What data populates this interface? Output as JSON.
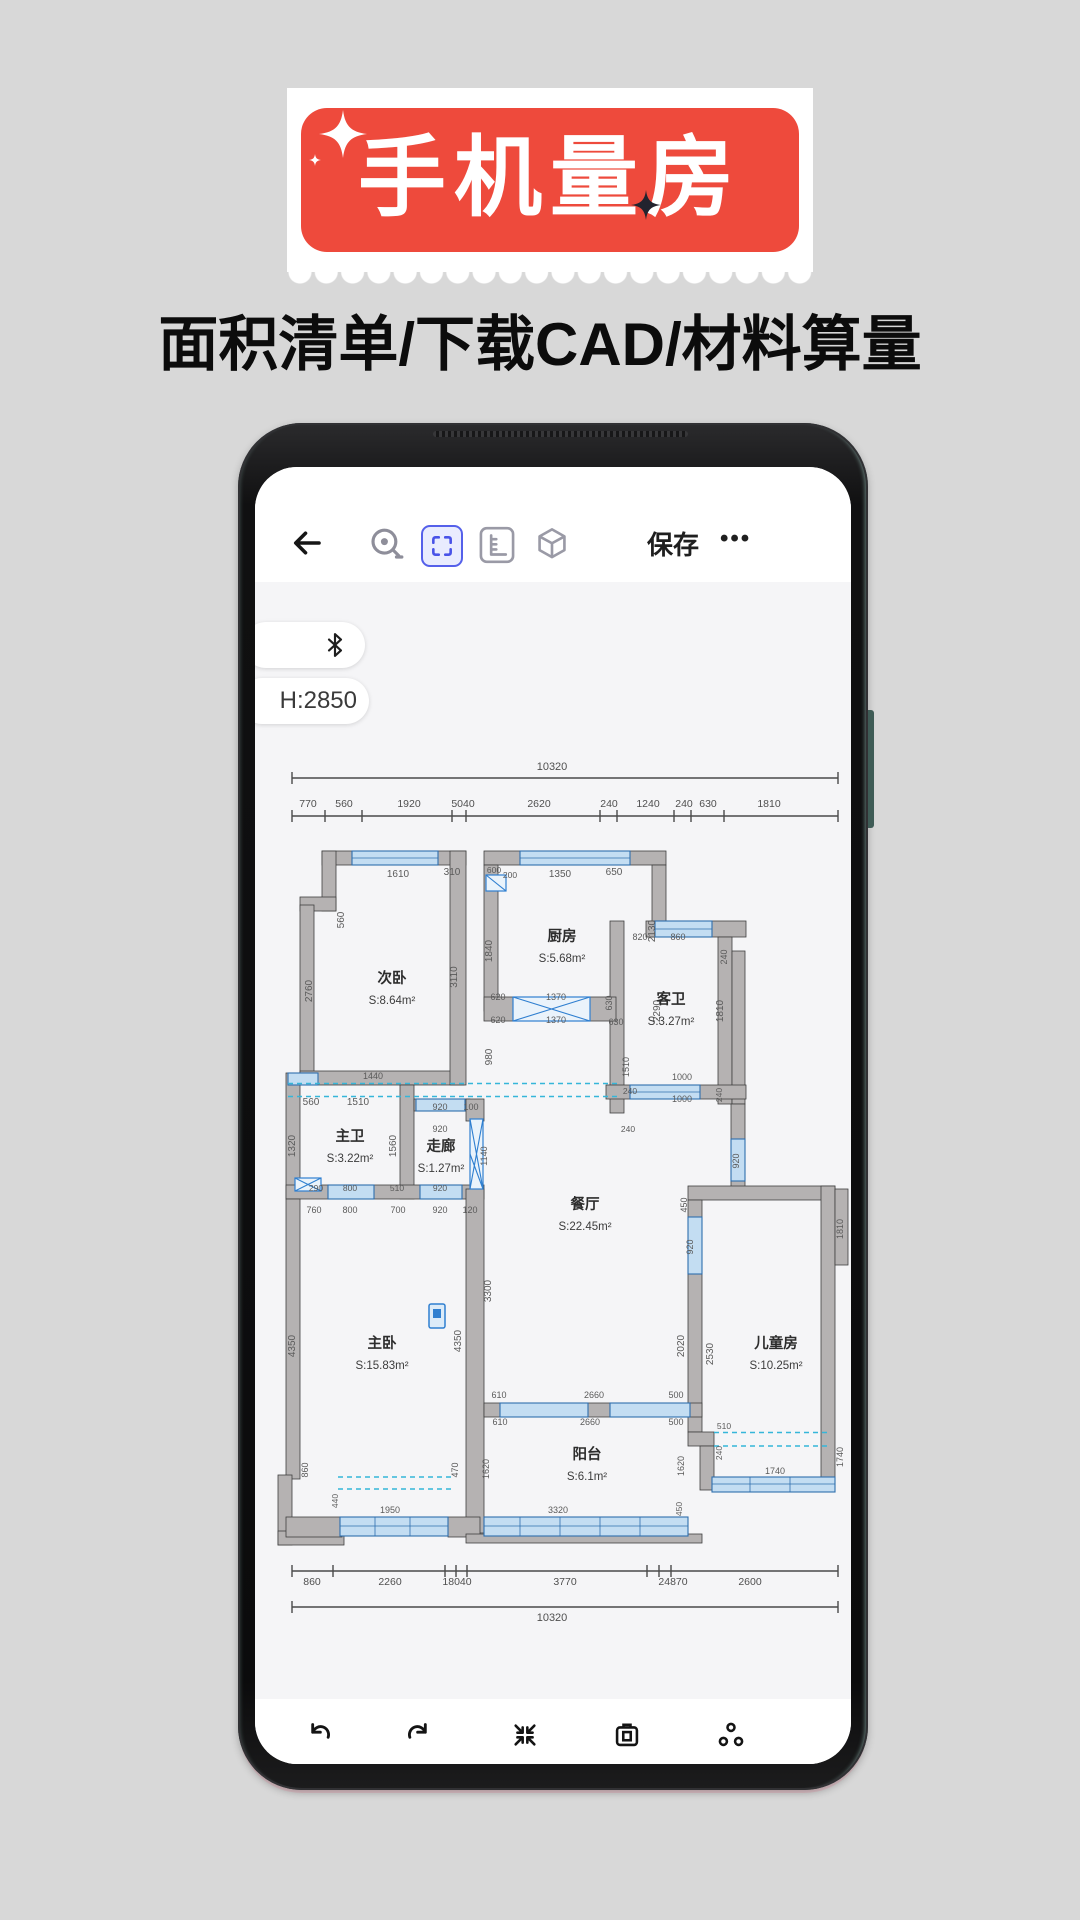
{
  "banner": {
    "title": "手机量房",
    "subtitle": "面积清单/下载CAD/材料算量",
    "accent_color": "#ee4a3c"
  },
  "phone_app": {
    "toolbar": {
      "save_label": "保存",
      "more_label": "•••",
      "active_tool_color": "#5560ea"
    },
    "pills": {
      "height_value": "H:2850"
    },
    "icons": [
      "back-arrow",
      "tape-measure",
      "selection-frame",
      "ruler",
      "cube-3d",
      "bluetooth",
      "undo",
      "redo",
      "collapse",
      "screenshot-camera",
      "nodes-share"
    ]
  },
  "floorplan": {
    "wall_color": "#b5b2b2",
    "window_color": "#c3ddf2",
    "rooms": [
      {
        "name": "次卧",
        "area": "S:8.64m²",
        "x": 392,
        "y": 984
      },
      {
        "name": "厨房",
        "area": "S:5.68m²",
        "x": 562,
        "y": 942
      },
      {
        "name": "客卫",
        "area": "S:3.27m²",
        "x": 671,
        "y": 1005
      },
      {
        "name": "主卫",
        "area": "S:3.22m²",
        "x": 350,
        "y": 1142
      },
      {
        "name": "走廊",
        "area": "S:1.27m²",
        "x": 441,
        "y": 1152
      },
      {
        "name": "餐厅",
        "area": "S:22.45m²",
        "x": 585,
        "y": 1210
      },
      {
        "name": "主卧",
        "area": "S:15.83m²",
        "x": 382,
        "y": 1349
      },
      {
        "name": "儿童房",
        "area": "S:10.25m²",
        "x": 776,
        "y": 1349
      },
      {
        "name": "阳台",
        "area": "S:6.1m²",
        "x": 587,
        "y": 1460
      }
    ],
    "dims": [
      {
        "t": "10320",
        "x": 552,
        "y": 771,
        "s": 11,
        "cls": "rlabel"
      },
      {
        "t": "770",
        "x": 308,
        "y": 808,
        "s": 10.5,
        "cls": "rlabel"
      },
      {
        "t": "560",
        "x": 344,
        "y": 808,
        "s": 10.5,
        "cls": "rlabel"
      },
      {
        "t": "1920",
        "x": 409,
        "y": 808,
        "s": 10.5,
        "cls": "rlabel"
      },
      {
        "t": "5040",
        "x": 463,
        "y": 808,
        "s": 10.5,
        "cls": "rlabel"
      },
      {
        "t": "2620",
        "x": 539,
        "y": 808,
        "s": 10.5,
        "cls": "rlabel"
      },
      {
        "t": "240",
        "x": 609,
        "y": 808,
        "s": 10.5,
        "cls": "rlabel"
      },
      {
        "t": "1240",
        "x": 648,
        "y": 808,
        "s": 10.5,
        "cls": "rlabel"
      },
      {
        "t": "240",
        "x": 684,
        "y": 808,
        "s": 10.5,
        "cls": "rlabel"
      },
      {
        "t": "630",
        "x": 708,
        "y": 808,
        "s": 10.5,
        "cls": "rlabel"
      },
      {
        "t": "1810",
        "x": 769,
        "y": 808,
        "s": 10.5,
        "cls": "rlabel"
      },
      {
        "t": "860",
        "x": 312,
        "y": 1586,
        "s": 10.5,
        "cls": "rlabel"
      },
      {
        "t": "2260",
        "x": 390,
        "y": 1586,
        "s": 10.5,
        "cls": "rlabel"
      },
      {
        "t": "18040",
        "x": 457,
        "y": 1586,
        "s": 10.5,
        "cls": "rlabel"
      },
      {
        "t": "3770",
        "x": 565,
        "y": 1586,
        "s": 10.5,
        "cls": "rlabel"
      },
      {
        "t": "24870",
        "x": 673,
        "y": 1586,
        "s": 10.5,
        "cls": "rlabel"
      },
      {
        "t": "2600",
        "x": 750,
        "y": 1586,
        "s": 10.5,
        "cls": "rlabel"
      },
      {
        "t": "10320",
        "x": 552,
        "y": 1622,
        "s": 11,
        "cls": "rlabel"
      },
      {
        "t": "1610",
        "x": 398,
        "y": 878
      },
      {
        "t": "310",
        "x": 452,
        "y": 876
      },
      {
        "t": "600",
        "x": 494,
        "y": 874,
        "s": 8.5
      },
      {
        "t": "200",
        "x": 510,
        "y": 879,
        "s": 8.5
      },
      {
        "t": "1350",
        "x": 560,
        "y": 878
      },
      {
        "t": "650",
        "x": 614,
        "y": 876
      },
      {
        "t": "560",
        "x": 344,
        "y": 921,
        "r": -90
      },
      {
        "t": "2760",
        "x": 312,
        "y": 992,
        "r": -90
      },
      {
        "t": "3110",
        "x": 457,
        "y": 978,
        "r": -90
      },
      {
        "t": "1840",
        "x": 492,
        "y": 952,
        "r": -90
      },
      {
        "t": "2130",
        "x": 655,
        "y": 932,
        "r": -90
      },
      {
        "t": "820",
        "x": 640,
        "y": 941,
        "s": 9
      },
      {
        "t": "860",
        "x": 678,
        "y": 941,
        "s": 9
      },
      {
        "t": "240",
        "x": 727,
        "y": 958,
        "r": -90,
        "s": 9
      },
      {
        "t": "620",
        "x": 498,
        "y": 1001,
        "s": 9
      },
      {
        "t": "1370",
        "x": 556,
        "y": 1001,
        "s": 9
      },
      {
        "t": "620",
        "x": 498,
        "y": 1024,
        "s": 9
      },
      {
        "t": "1370",
        "x": 556,
        "y": 1024,
        "s": 9
      },
      {
        "t": "980",
        "x": 492,
        "y": 1058,
        "r": -90
      },
      {
        "t": "630",
        "x": 612,
        "y": 1004,
        "r": -90,
        "s": 9
      },
      {
        "t": "630",
        "x": 616,
        "y": 1026,
        "s": 9
      },
      {
        "t": "2290",
        "x": 660,
        "y": 1012,
        "r": -90
      },
      {
        "t": "1810",
        "x": 723,
        "y": 1012,
        "r": -90
      },
      {
        "t": "1440",
        "x": 373,
        "y": 1080,
        "s": 9
      },
      {
        "t": "1510",
        "x": 629,
        "y": 1068,
        "r": -90,
        "s": 9
      },
      {
        "t": "240",
        "x": 630,
        "y": 1095,
        "s": 8.5
      },
      {
        "t": "1000",
        "x": 682,
        "y": 1081,
        "s": 9
      },
      {
        "t": "1000",
        "x": 682,
        "y": 1103,
        "s": 9
      },
      {
        "t": "240",
        "x": 722,
        "y": 1096,
        "r": -90,
        "s": 8.5
      },
      {
        "t": "240",
        "x": 628,
        "y": 1133,
        "s": 8.5
      },
      {
        "t": "920",
        "x": 739,
        "y": 1162,
        "r": -90,
        "s": 9
      },
      {
        "t": "560",
        "x": 311,
        "y": 1106
      },
      {
        "t": "1510",
        "x": 358,
        "y": 1106
      },
      {
        "t": "1320",
        "x": 295,
        "y": 1147,
        "r": -90
      },
      {
        "t": "1560",
        "x": 396,
        "y": 1147,
        "r": -90
      },
      {
        "t": "920",
        "x": 440,
        "y": 1111,
        "s": 9
      },
      {
        "t": "100",
        "x": 471,
        "y": 1111,
        "s": 9
      },
      {
        "t": "920",
        "x": 440,
        "y": 1133,
        "s": 9
      },
      {
        "t": "1140",
        "x": 487,
        "y": 1157,
        "r": -90,
        "s": 9
      },
      {
        "t": "290",
        "x": 316,
        "y": 1192,
        "s": 8.5
      },
      {
        "t": "800",
        "x": 350,
        "y": 1192,
        "s": 8.5
      },
      {
        "t": "510",
        "x": 397,
        "y": 1192,
        "s": 8.5
      },
      {
        "t": "920",
        "x": 440,
        "y": 1192,
        "s": 8.5
      },
      {
        "t": "760",
        "x": 314,
        "y": 1214,
        "s": 9
      },
      {
        "t": "800",
        "x": 350,
        "y": 1214,
        "s": 9
      },
      {
        "t": "700",
        "x": 398,
        "y": 1214,
        "s": 9
      },
      {
        "t": "920",
        "x": 440,
        "y": 1214,
        "s": 9
      },
      {
        "t": "120",
        "x": 470,
        "y": 1214,
        "s": 9
      },
      {
        "t": "450",
        "x": 687,
        "y": 1206,
        "r": -90,
        "s": 9
      },
      {
        "t": "920",
        "x": 693,
        "y": 1248,
        "r": -90,
        "s": 9
      },
      {
        "t": "3300",
        "x": 491,
        "y": 1292,
        "r": -90
      },
      {
        "t": "2020",
        "x": 684,
        "y": 1347,
        "r": -90
      },
      {
        "t": "2530",
        "x": 713,
        "y": 1355,
        "r": -90
      },
      {
        "t": "1810",
        "x": 843,
        "y": 1230,
        "r": -90,
        "s": 9
      },
      {
        "t": "4350",
        "x": 295,
        "y": 1347,
        "r": -90
      },
      {
        "t": "4350",
        "x": 461,
        "y": 1342,
        "r": -90
      },
      {
        "t": "610",
        "x": 499,
        "y": 1399,
        "s": 9
      },
      {
        "t": "2660",
        "x": 594,
        "y": 1399,
        "s": 9
      },
      {
        "t": "500",
        "x": 676,
        "y": 1399,
        "s": 9
      },
      {
        "t": "610",
        "x": 500,
        "y": 1426,
        "s": 9
      },
      {
        "t": "2660",
        "x": 590,
        "y": 1426,
        "s": 9
      },
      {
        "t": "500",
        "x": 676,
        "y": 1426,
        "s": 9
      },
      {
        "t": "510",
        "x": 724,
        "y": 1430,
        "s": 8.5
      },
      {
        "t": "240",
        "x": 722,
        "y": 1454,
        "r": -90,
        "s": 8.5
      },
      {
        "t": "1620",
        "x": 489,
        "y": 1470,
        "r": -90,
        "s": 9
      },
      {
        "t": "1620",
        "x": 684,
        "y": 1467,
        "r": -90,
        "s": 9
      },
      {
        "t": "860",
        "x": 308,
        "y": 1471,
        "r": -90,
        "s": 9
      },
      {
        "t": "470",
        "x": 458,
        "y": 1471,
        "r": -90,
        "s": 9
      },
      {
        "t": "440",
        "x": 338,
        "y": 1502,
        "r": -90,
        "s": 8.5
      },
      {
        "t": "1950",
        "x": 390,
        "y": 1514,
        "s": 9
      },
      {
        "t": "1740",
        "x": 775,
        "y": 1475,
        "s": 9
      },
      {
        "t": "1740",
        "x": 843,
        "y": 1458,
        "r": -90,
        "s": 9
      },
      {
        "t": "3320",
        "x": 558,
        "y": 1514,
        "s": 9
      },
      {
        "t": "450",
        "x": 682,
        "y": 1510,
        "r": -90,
        "s": 8.5
      }
    ]
  }
}
